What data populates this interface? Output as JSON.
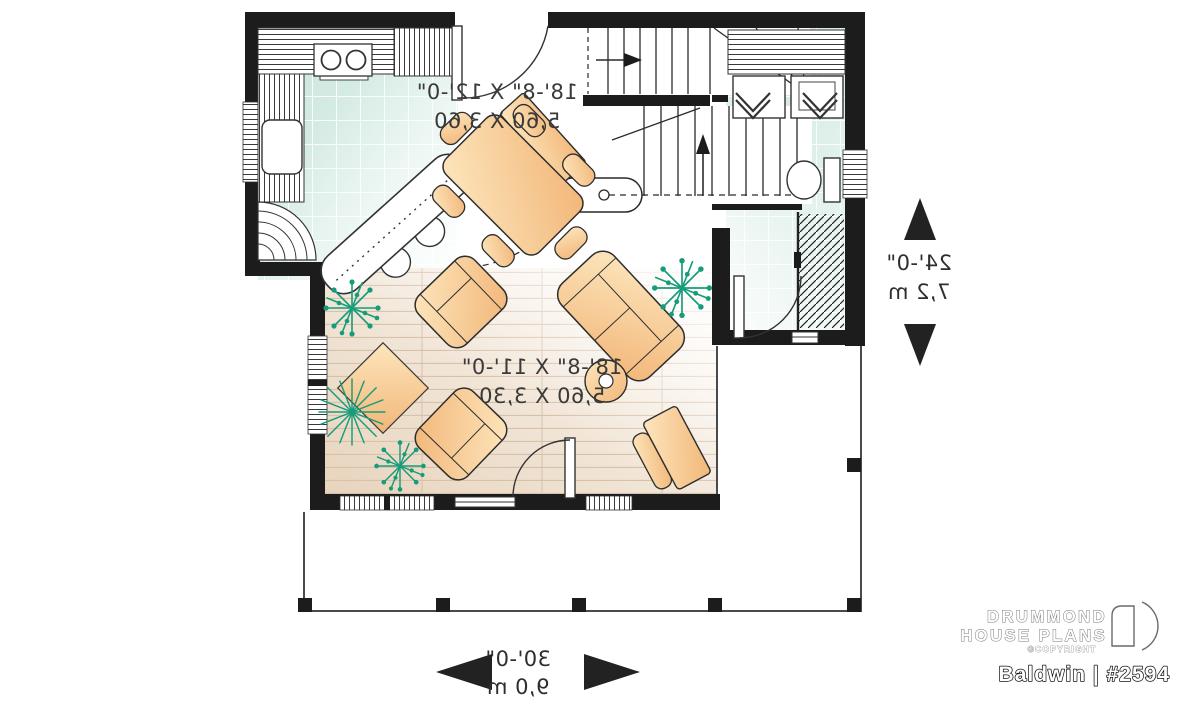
{
  "labels": {
    "dining_kitchen": {
      "imperial": "18'-8\" X 12'-0\"",
      "metric": "5,60 X 3,60"
    },
    "living_room": {
      "imperial": "18'-8\" X 11'-0\"",
      "metric": "5,60 X 3,30"
    },
    "overall_depth": {
      "imperial": "24'-0\"",
      "metric": "7,2 m"
    },
    "overall_width": {
      "imperial": "30'-0\"",
      "metric": "9,0 m"
    }
  },
  "branding": {
    "brand_line1": "DRUMMOND",
    "brand_line2": "HOUSE PLANS",
    "copyright": "©COPYRIGHT",
    "plan_name": "Baldwin | #2594"
  },
  "colors": {
    "walls": "#1c1c1c",
    "tile_floor": "#cde7df",
    "wood_floor": "#ecdcc8",
    "furniture": "#f7c387",
    "plants": "#169c7b",
    "annotation": "#3a3a3a"
  }
}
